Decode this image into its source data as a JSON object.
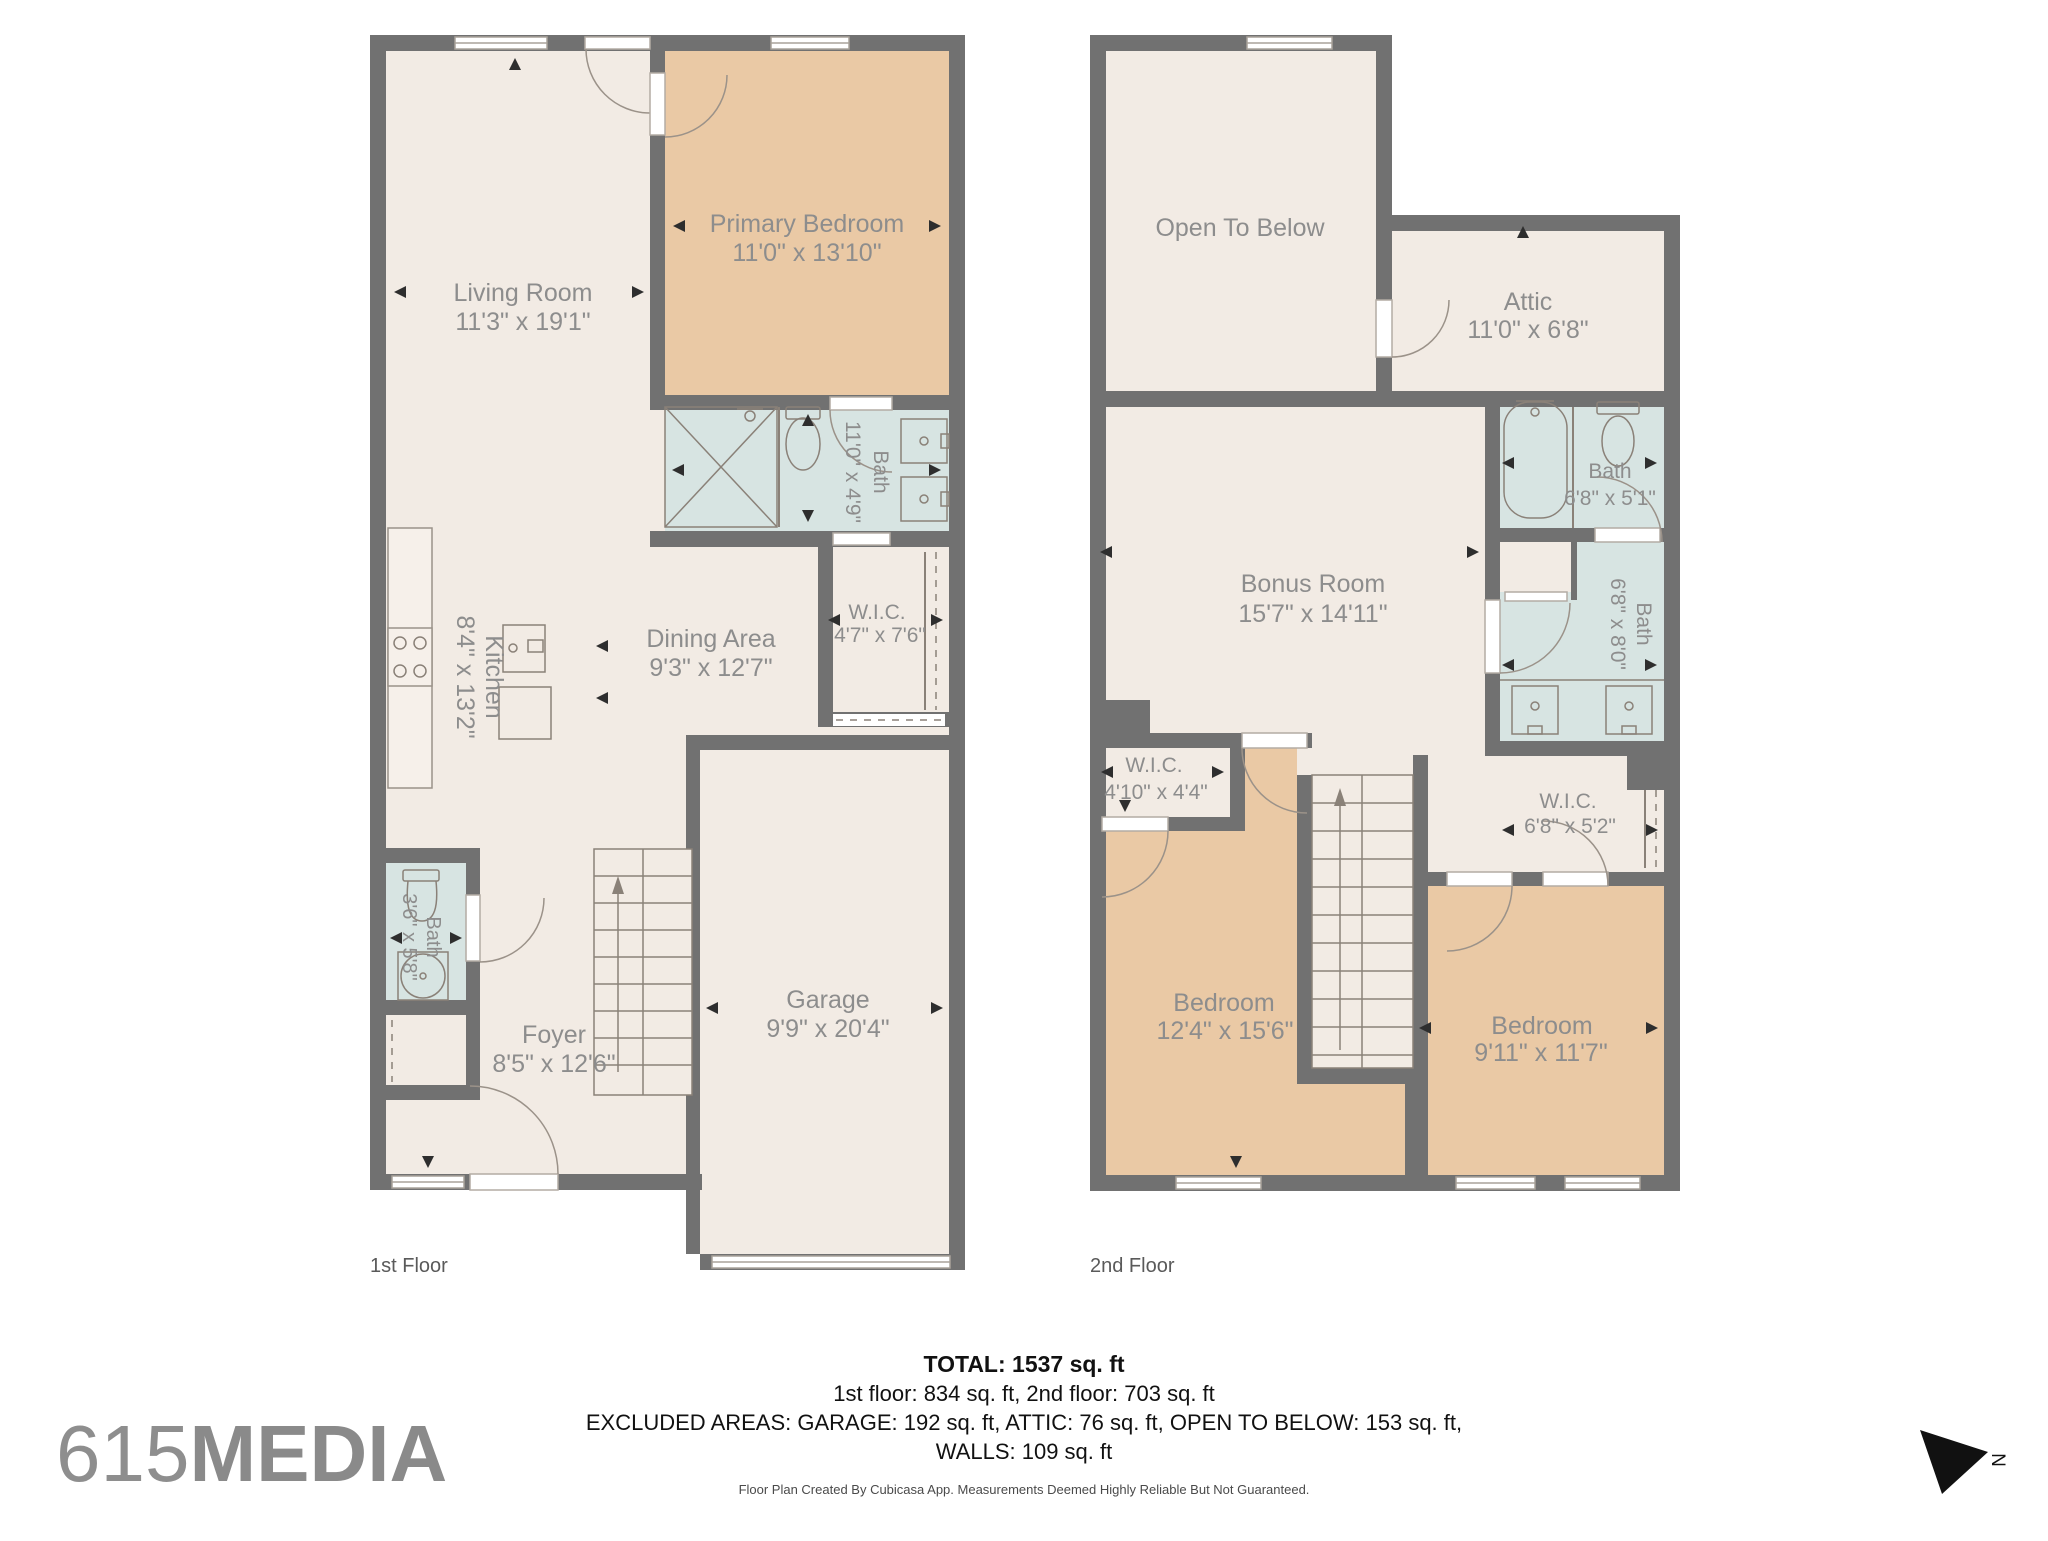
{
  "branding": {
    "logo_prefix": "615",
    "logo_suffix": "MEDIA",
    "compass_label": "N"
  },
  "floor1": {
    "label": "1st Floor",
    "rooms": [
      {
        "name": "Living Room",
        "dims": "11'3\" x 19'1\""
      },
      {
        "name": "Primary Bedroom",
        "dims": "11'0\" x 13'10\""
      },
      {
        "name": "Bath",
        "dims": "11'0\" x 4'9\""
      },
      {
        "name": "W.I.C.",
        "dims": "4'7\" x 7'6\""
      },
      {
        "name": "Dining Area",
        "dims": "9'3\" x 12'7\""
      },
      {
        "name": "Kitchen",
        "dims": "8'4\" x 13'2\""
      },
      {
        "name": "Bath",
        "dims": "3'6\" x 5'8\""
      },
      {
        "name": "Foyer",
        "dims": "8'5\" x 12'6\""
      },
      {
        "name": "Garage",
        "dims": "9'9\" x 20'4\""
      }
    ]
  },
  "floor2": {
    "label": "2nd Floor",
    "rooms": [
      {
        "name": "Open To Below",
        "dims": ""
      },
      {
        "name": "Attic",
        "dims": "11'0\" x 6'8\""
      },
      {
        "name": "Bonus Room",
        "dims": "15'7\" x 14'11\""
      },
      {
        "name": "Bath",
        "dims": "6'8\" x 5'1\""
      },
      {
        "name": "Bath",
        "dims": "6'8\" x 8'0\""
      },
      {
        "name": "W.I.C.",
        "dims": "4'10\" x 4'4\""
      },
      {
        "name": "W.I.C.",
        "dims": "6'8\" x 5'2\""
      },
      {
        "name": "Bedroom",
        "dims": "12'4\" x 15'6\""
      },
      {
        "name": "Bedroom",
        "dims": "9'11\" x 11'7\""
      }
    ]
  },
  "summary": {
    "total": "TOTAL: 1537 sq. ft",
    "floors": "1st floor: 834 sq. ft, 2nd floor: 703 sq. ft",
    "excluded": "EXCLUDED AREAS: GARAGE: 192 sq. ft, ATTIC: 76 sq. ft, OPEN TO BELOW: 153 sq. ft,",
    "walls": "WALLS: 109 sq. ft",
    "disclaimer": "Floor Plan Created By Cubicasa App. Measurements Deemed Highly Reliable But Not Guaranteed."
  },
  "colors": {
    "wall": "#717171",
    "floor": "#f2ebe4",
    "bedroom_fill": "#eac9a5",
    "bath_fill": "#d7e4e2",
    "room_label": "#8d8d8d",
    "fixture_stroke": "#8a8178",
    "summary_text": "#111111",
    "logo_gray": "#8e8e8e"
  }
}
